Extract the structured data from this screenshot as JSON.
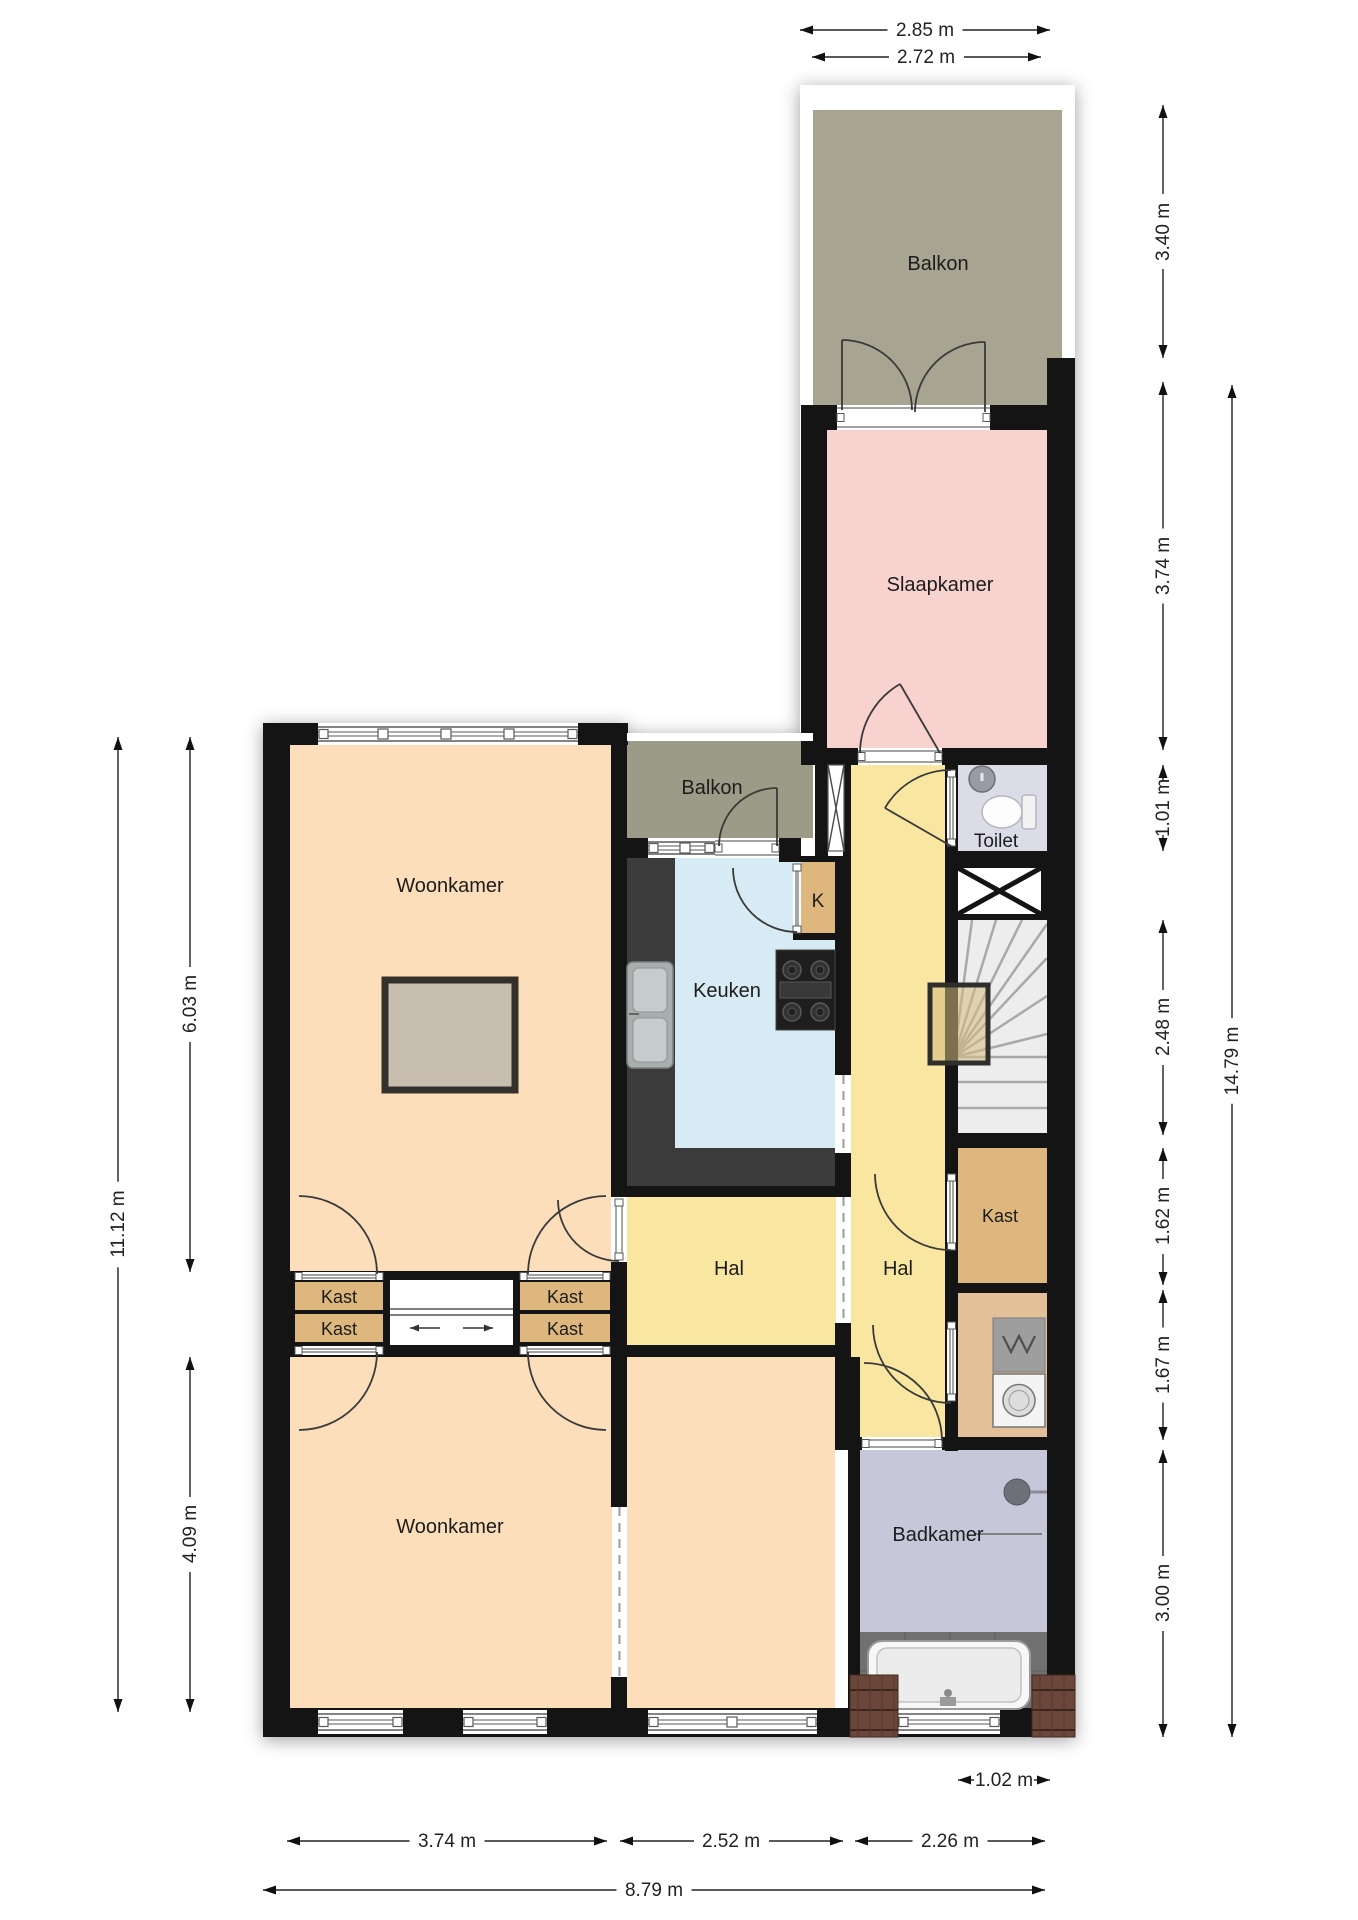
{
  "plan": {
    "width": 1358,
    "height": 1920,
    "colors": {
      "wall": "#141414",
      "white": "#ffffff",
      "olive1": "#a7a592",
      "olive2": "#9c9b87",
      "pink": "#f8d2ce",
      "peach": "#fcdebb",
      "yellow": "#f9e7a1",
      "blue": "#d6ebf4",
      "lav1": "#dcdce8",
      "lav2": "#c7c7da",
      "tan": "#ddb77d",
      "laundry": "#e3c097",
      "stairs": "#ededed",
      "tile": "#717171",
      "counter": "#3b3b3b",
      "rugfill": "#c7beb0",
      "rugline": "#34302b",
      "dim": "#222222",
      "label": "#1c1c1c",
      "doorline": "#3a3a3a"
    },
    "silhouette": [
      [
        263,
        723,
        365,
        1014
      ],
      [
        625,
        733,
        188,
        1004
      ],
      [
        800,
        85,
        275,
        1652
      ]
    ],
    "rooms": [
      {
        "name": "balkon-boven",
        "label": "Balkon",
        "lx": 938,
        "ly": 263,
        "x": 813,
        "y": 110,
        "w": 249,
        "h": 295,
        "c": "olive1"
      },
      {
        "name": "slaapkamer",
        "label": "Slaapkamer",
        "lx": 940,
        "ly": 584,
        "x": 827,
        "y": 430,
        "w": 220,
        "h": 318,
        "c": "pink"
      },
      {
        "name": "balkon-klein",
        "label": "Balkon",
        "lx": 712,
        "ly": 787,
        "x": 627,
        "y": 741,
        "w": 186,
        "h": 97,
        "c": "olive2"
      },
      {
        "name": "woonkamer-boven",
        "label": "Woonkamer",
        "lx": 450,
        "ly": 885,
        "x": 290,
        "y": 745,
        "w": 321,
        "h": 527,
        "c": "peach"
      },
      {
        "name": "keuken",
        "label": "Keuken",
        "lx": 727,
        "ly": 990,
        "x": 623,
        "y": 858,
        "w": 212,
        "h": 328,
        "c": "blue"
      },
      {
        "name": "kast-k",
        "label": "K",
        "lx": 818,
        "ly": 900,
        "x": 801,
        "y": 862,
        "w": 34,
        "h": 73,
        "c": "tan",
        "fs": 19
      },
      {
        "name": "hal-rechts",
        "label": "Hal",
        "lx": 898,
        "ly": 1268,
        "x": 851,
        "y": 765,
        "w": 94,
        "h": 672,
        "c": "yellow"
      },
      {
        "name": "toilet",
        "label": "Toilet",
        "lx": 996,
        "ly": 840,
        "x": 956,
        "y": 765,
        "w": 91,
        "h": 86,
        "c": "lav1",
        "fs": 19
      },
      {
        "name": "trap",
        "label": "",
        "x": 950,
        "y": 920,
        "w": 97,
        "h": 213,
        "c": "stairs"
      },
      {
        "name": "kast-rechts",
        "label": "Kast",
        "lx": 1000,
        "ly": 1215,
        "x": 958,
        "y": 1148,
        "w": 89,
        "h": 135,
        "c": "tan",
        "fs": 18
      },
      {
        "name": "wasruimte",
        "label": "",
        "x": 958,
        "y": 1293,
        "w": 89,
        "h": 144,
        "c": "laundry"
      },
      {
        "name": "hal-links",
        "label": "Hal",
        "lx": 729,
        "ly": 1268,
        "x": 627,
        "y": 1197,
        "w": 224,
        "h": 148,
        "c": "yellow"
      },
      {
        "name": "woonkamer-beneden",
        "label": "Woonkamer",
        "lx": 450,
        "ly": 1526,
        "x": 290,
        "y": 1357,
        "w": 322,
        "h": 351,
        "c": "peach"
      },
      {
        "name": "kamer-midden",
        "label": "",
        "x": 627,
        "y": 1357,
        "w": 208,
        "h": 351,
        "c": "peach"
      },
      {
        "name": "badkamer",
        "label": "Badkamer",
        "lx": 938,
        "ly": 1534,
        "x": 860,
        "y": 1450,
        "w": 187,
        "h": 182,
        "c": "lav2"
      }
    ],
    "extra_labels": [
      {
        "t": "Kast",
        "x": 339,
        "y": 1297,
        "s": 18
      },
      {
        "t": "Kast",
        "x": 339,
        "y": 1329,
        "s": 18
      },
      {
        "t": "Kast",
        "x": 565,
        "y": 1297,
        "s": 18
      },
      {
        "t": "Kast",
        "x": 565,
        "y": 1329,
        "s": 18
      }
    ],
    "walls": [
      [
        263,
        723,
        27,
        1014
      ],
      [
        263,
        723,
        365,
        22
      ],
      [
        611,
        723,
        16,
        474
      ],
      [
        611,
        1262,
        16,
        245
      ],
      [
        611,
        1677,
        16,
        60
      ],
      [
        263,
        1708,
        812,
        29
      ],
      [
        801,
        405,
        26,
        358
      ],
      [
        1047,
        358,
        28,
        1379
      ],
      [
        801,
        748,
        274,
        17
      ],
      [
        801,
        405,
        36,
        25
      ],
      [
        990,
        405,
        60,
        25
      ],
      [
        815,
        763,
        13,
        95
      ],
      [
        843,
        763,
        8,
        95
      ],
      [
        627,
        838,
        21,
        20
      ],
      [
        779,
        838,
        22,
        20
      ],
      [
        779,
        856,
        72,
        6
      ],
      [
        835,
        858,
        16,
        217
      ],
      [
        835,
        1153,
        16,
        44
      ],
      [
        835,
        1323,
        16,
        34
      ],
      [
        835,
        1357,
        25,
        93
      ],
      [
        848,
        1450,
        12,
        287
      ],
      [
        945,
        763,
        13,
        688
      ],
      [
        945,
        851,
        130,
        11
      ],
      [
        945,
        1133,
        130,
        15
      ],
      [
        945,
        1283,
        130,
        10
      ],
      [
        835,
        1437,
        240,
        13
      ],
      [
        290,
        1271,
        337,
        9
      ],
      [
        290,
        1345,
        561,
        12
      ],
      [
        383,
        1271,
        7,
        86
      ],
      [
        513,
        1271,
        7,
        86
      ],
      [
        610,
        1271,
        17,
        86
      ],
      [
        290,
        1271,
        5,
        86
      ],
      [
        611,
        1186,
        240,
        11
      ],
      [
        793,
        933,
        58,
        7
      ]
    ],
    "white_borders": [
      [
        800,
        85,
        13,
        320
      ],
      [
        800,
        85,
        275,
        25
      ],
      [
        1062,
        85,
        13,
        273
      ],
      [
        627,
        733,
        186,
        8
      ]
    ],
    "windows": [
      {
        "x": 318,
        "y": 723,
        "w": 260,
        "h": 22,
        "m": [
          383,
          446,
          509
        ]
      },
      {
        "x": 318,
        "y": 1710,
        "w": 85,
        "h": 24,
        "m": []
      },
      {
        "x": 463,
        "y": 1710,
        "w": 84,
        "h": 24,
        "m": []
      },
      {
        "x": 648,
        "y": 1710,
        "w": 169,
        "h": 24,
        "m": [
          732
        ]
      },
      {
        "x": 898,
        "y": 1710,
        "w": 102,
        "h": 24,
        "m": []
      },
      {
        "x": 648,
        "y": 838,
        "w": 67,
        "h": 20,
        "m": [
          685
        ]
      }
    ],
    "xwindow": {
      "x": 828,
      "y": 765,
      "w": 16,
      "h": 86
    },
    "sills": [
      {
        "x": 837,
        "y": 405,
        "w": 153,
        "h": 25,
        "o": "h"
      },
      {
        "x": 858,
        "y": 748,
        "w": 84,
        "h": 17,
        "o": "h"
      },
      {
        "x": 715,
        "y": 838,
        "w": 64,
        "h": 20,
        "o": "h"
      },
      {
        "x": 862,
        "y": 1437,
        "w": 80,
        "h": 13,
        "o": "h"
      },
      {
        "x": 947,
        "y": 770,
        "w": 9,
        "h": 76,
        "o": "v"
      },
      {
        "x": 947,
        "y": 1174,
        "w": 9,
        "h": 76,
        "o": "v"
      },
      {
        "x": 947,
        "y": 1322,
        "w": 9,
        "h": 79,
        "o": "v"
      },
      {
        "x": 613,
        "y": 1199,
        "w": 12,
        "h": 61,
        "o": "v"
      },
      {
        "x": 793,
        "y": 864,
        "w": 8,
        "h": 69,
        "o": "v"
      },
      {
        "x": 295,
        "y": 1272,
        "w": 88,
        "h": 9,
        "o": "h"
      },
      {
        "x": 520,
        "y": 1272,
        "w": 90,
        "h": 9,
        "o": "h"
      },
      {
        "x": 295,
        "y": 1346,
        "w": 88,
        "h": 9,
        "o": "h"
      },
      {
        "x": 520,
        "y": 1346,
        "w": 90,
        "h": 9,
        "o": "h"
      }
    ],
    "openings": [
      {
        "x": 612,
        "y": 1507,
        "w": 15,
        "h": 170
      },
      {
        "x": 836,
        "y": 1075,
        "w": 15,
        "h": 78
      },
      {
        "x": 836,
        "y": 1197,
        "w": 15,
        "h": 126
      }
    ],
    "doors": [
      {
        "name": "balkondeur-links",
        "d": "M912,410 A70,70 0 0 0 842,340",
        "leaf": [
          842,
          410,
          842,
          340
        ]
      },
      {
        "name": "balkondeur-rechts",
        "d": "M915,412 A70,70 0 0 1 985,342",
        "leaf": [
          985,
          412,
          985,
          342
        ]
      },
      {
        "name": "balkon-klein-deur",
        "d": "M719,846 A58,58 0 0 1 777,788",
        "leaf": [
          777,
          846,
          777,
          788
        ]
      },
      {
        "name": "slaapkamer-deur",
        "d": "M860,753 A80,80 0 0 1 900,684",
        "leaf": [
          940,
          753,
          900,
          684
        ]
      },
      {
        "name": "toilet-deur",
        "d": "M951,770 A76,76 0 0 0 885,808",
        "leaf": [
          951,
          846,
          885,
          808
        ]
      },
      {
        "name": "kast-rechts-deur",
        "d": "M875,1174 A76,76 0 0 0 951,1250",
        "leaf": null
      },
      {
        "name": "wasruimte-deur",
        "d": "M873,1325 A78,78 0 0 0 951,1403",
        "leaf": null
      },
      {
        "name": "badkamer-deur",
        "d": "M942,1441 A78,78 0 0 0 864,1363",
        "leaf": null
      },
      {
        "name": "hal-links-deur",
        "d": "M619,1261 A61,61 0 0 1 558,1200",
        "leaf": null
      },
      {
        "name": "kast-k-deur",
        "d": "M733,868 A64,64 0 0 0 797,932",
        "leaf": null
      },
      {
        "name": "kast-l-deur-boven",
        "d": "M377,1274 A78,78 0 0 0 299,1196",
        "leaf": null
      },
      {
        "name": "kast-l-deur-onder",
        "d": "M377,1352 A78,78 0 0 1 299,1430",
        "leaf": null
      },
      {
        "name": "kast-r-deur-boven",
        "d": "M528,1274 A78,78 0 0 1 606,1196",
        "leaf": null
      },
      {
        "name": "kast-r-deur-onder",
        "d": "M528,1352 A78,78 0 0 0 606,1430",
        "leaf": null
      }
    ],
    "kasts": {
      "frames": [
        [
          293,
          1280,
          92,
          65
        ],
        [
          518,
          1280,
          94,
          65
        ]
      ],
      "cells": [
        [
          295,
          1282,
          88,
          28
        ],
        [
          295,
          1314,
          88,
          28
        ],
        [
          520,
          1282,
          90,
          28
        ],
        [
          520,
          1314,
          90,
          28
        ]
      ]
    },
    "slider": {
      "track": [
        390,
        1306,
        513,
        1318
      ],
      "arrows": [
        [
          440,
          1328,
          410,
          1328
        ],
        [
          463,
          1328,
          493,
          1328
        ]
      ]
    },
    "stairs": {
      "x": 950,
      "y": 920,
      "w": 97,
      "h": 213,
      "px": 954,
      "py": 1057,
      "rays": [
        [
          972,
          920
        ],
        [
          996,
          920
        ],
        [
          1022,
          920
        ],
        [
          1047,
          924
        ],
        [
          1047,
          958
        ],
        [
          1047,
          996
        ],
        [
          1047,
          1034
        ]
      ],
      "treads": [
        1057,
        1082,
        1108
      ]
    },
    "shaft": {
      "x": 952,
      "y": 862,
      "w": 95,
      "h": 58,
      "ix": 958,
      "iy": 868,
      "iw": 83,
      "ih": 46
    },
    "fixtures": {
      "counters": [
        [
          623,
          858,
          52,
          328
        ],
        [
          623,
          1148,
          212,
          38
        ]
      ],
      "rug": [
        385,
        980,
        130,
        110
      ],
      "sink": {
        "x": 627,
        "y": 962,
        "w": 46,
        "h": 106,
        "basins": [
          [
            633,
            968,
            34,
            44
          ],
          [
            633,
            1018,
            34,
            44
          ]
        ]
      },
      "stove": {
        "x": 776,
        "y": 950,
        "w": 59,
        "h": 80,
        "burners": [
          [
            792,
            970
          ],
          [
            820,
            970
          ],
          [
            792,
            1012
          ],
          [
            820,
            1012
          ]
        ],
        "bar": [
          780,
          982,
          51,
          16
        ]
      },
      "wc": {
        "sink": [
          982,
          779,
          13
        ],
        "bowl": [
          1002,
          812,
          20,
          16
        ],
        "tank": [
          1022,
          795,
          14,
          34
        ]
      },
      "laundry": {
        "tub": [
          993,
          1318,
          52,
          54
        ],
        "washer": [
          993,
          1374,
          52,
          53
        ]
      },
      "shower": {
        "c": [
          1017,
          1492,
          13
        ],
        "arm": [
          1030,
          1492,
          1047,
          1492
        ]
      },
      "tiles": [
        860,
        1632,
        187,
        78
      ],
      "tub": {
        "x": 868,
        "y": 1641,
        "w": 162,
        "h": 68
      },
      "rooftiles": [
        [
          850,
          1675,
          48,
          62
        ],
        [
          1032,
          1675,
          43,
          62
        ]
      ],
      "overlay": [
        930,
        985,
        58,
        78
      ],
      "leader": [
        975,
        1534,
        1042,
        1534
      ]
    },
    "dimensions": [
      {
        "t": "2.85 m",
        "x1": 800,
        "y1": 30,
        "x2": 1050,
        "y2": 30,
        "tx": 925,
        "ty": 30,
        "rot": false
      },
      {
        "t": "2.72 m",
        "x1": 812,
        "y1": 57,
        "x2": 1041,
        "y2": 57,
        "tx": 926,
        "ty": 57,
        "rot": false
      },
      {
        "t": "3.40 m",
        "x1": 1163,
        "y1": 105,
        "x2": 1163,
        "y2": 358,
        "tx": 1163,
        "ty": 232,
        "rot": true
      },
      {
        "t": "3.74 m",
        "x1": 1163,
        "y1": 382,
        "x2": 1163,
        "y2": 750,
        "tx": 1163,
        "ty": 566,
        "rot": true
      },
      {
        "t": "1.01 m",
        "x1": 1163,
        "y1": 765,
        "x2": 1163,
        "y2": 851,
        "tx": 1163,
        "ty": 808,
        "rot": true
      },
      {
        "t": "2.48 m",
        "x1": 1163,
        "y1": 920,
        "x2": 1163,
        "y2": 1135,
        "tx": 1163,
        "ty": 1027,
        "rot": true
      },
      {
        "t": "1.62 m",
        "x1": 1163,
        "y1": 1148,
        "x2": 1163,
        "y2": 1285,
        "tx": 1163,
        "ty": 1216,
        "rot": true
      },
      {
        "t": "1.67 m",
        "x1": 1163,
        "y1": 1290,
        "x2": 1163,
        "y2": 1440,
        "tx": 1163,
        "ty": 1365,
        "rot": true
      },
      {
        "t": "3.00 m",
        "x1": 1163,
        "y1": 1450,
        "x2": 1163,
        "y2": 1737,
        "tx": 1163,
        "ty": 1593,
        "rot": true
      },
      {
        "t": "14.79 m",
        "x1": 1232,
        "y1": 385,
        "x2": 1232,
        "y2": 1737,
        "tx": 1232,
        "ty": 1061,
        "rot": true
      },
      {
        "t": "6.03 m",
        "x1": 190,
        "y1": 737,
        "x2": 190,
        "y2": 1272,
        "tx": 190,
        "ty": 1004,
        "rot": true
      },
      {
        "t": "11.12 m",
        "x1": 118,
        "y1": 737,
        "x2": 118,
        "y2": 1712,
        "tx": 118,
        "ty": 1224,
        "rot": true
      },
      {
        "t": "4.09 m",
        "x1": 190,
        "y1": 1357,
        "x2": 190,
        "y2": 1712,
        "tx": 190,
        "ty": 1534,
        "rot": true
      },
      {
        "t": "3.74 m",
        "x1": 287,
        "y1": 1841,
        "x2": 607,
        "y2": 1841,
        "tx": 447,
        "ty": 1841,
        "rot": false
      },
      {
        "t": "2.52 m",
        "x1": 620,
        "y1": 1841,
        "x2": 843,
        "y2": 1841,
        "tx": 731,
        "ty": 1841,
        "rot": false
      },
      {
        "t": "2.26 m",
        "x1": 855,
        "y1": 1841,
        "x2": 1045,
        "y2": 1841,
        "tx": 950,
        "ty": 1841,
        "rot": false
      },
      {
        "t": "8.79 m",
        "x1": 263,
        "y1": 1890,
        "x2": 1045,
        "y2": 1890,
        "tx": 654,
        "ty": 1890,
        "rot": false
      },
      {
        "t": "1.02 m",
        "x1": 958,
        "y1": 1780,
        "x2": 1050,
        "y2": 1780,
        "tx": 1004,
        "ty": 1780,
        "rot": false
      }
    ]
  }
}
